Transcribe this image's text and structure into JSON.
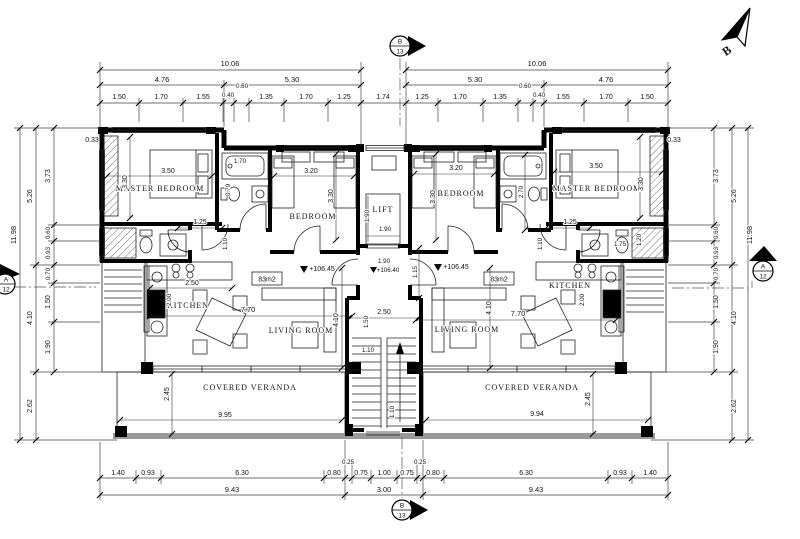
{
  "compass": {
    "north_letter": "B"
  },
  "markers": {
    "top": {
      "letter": "B",
      "number": "13"
    },
    "bottom": {
      "letter": "B",
      "number": "13"
    },
    "left": {
      "letter": "A",
      "number": "12"
    },
    "right": {
      "letter": "A",
      "number": "12"
    }
  },
  "core": {
    "lift_label": "LIFT",
    "lift_w": "1.90",
    "lift_d": "1.90",
    "landing_w": "1.90",
    "landing_level": "+106.40",
    "landing_d": "1.15",
    "stair_w": "2.50",
    "stair_d1": "1.50",
    "stair_d2": "1.10",
    "stair_d3": "1.10"
  },
  "apartments": {
    "left": {
      "master_label": "MASTER BEDROOM",
      "master_w": "3.50",
      "master_d": "3.30",
      "master_door": "1.25",
      "bedroom_label": "BEDROOM",
      "bedroom_w": "3.20",
      "bedroom_d": "3.30",
      "tub": "1.70",
      "wc": "0.70",
      "hall": "1.10",
      "kitchen_label": "KITCHEN",
      "kitchen_w": "2.50",
      "kitchen_d": "2.00",
      "living_label": "LIVING ROOM",
      "living_w": "7.70",
      "living_d": "4.10",
      "area": "83m2",
      "level": "+106.45",
      "veranda_label": "COVERED VERANDA",
      "veranda_w": "9.95",
      "veranda_d": "2.45",
      "corner": "0.33"
    },
    "right": {
      "master_label": "MASTER BEDROOM",
      "master_w": "3.50",
      "master_d": "3.30",
      "master_door": "1.25",
      "bedroom_label": "BEDROOM",
      "bedroom_w": "3.20",
      "bedroom_d": "3.30",
      "bath_d": "2.70",
      "hall": "1.10",
      "ensuite_w": "1.75",
      "ensuite_d": "1.20",
      "kitchen_label": "KITCHEN",
      "kitchen_d": "2.00",
      "living_label": "LIVING ROOM",
      "living_w": "7.70",
      "living_d": "4.10",
      "area": "83m2",
      "level": "+106.45",
      "veranda_label": "COVERED VERANDA",
      "veranda_w": "9.94",
      "veranda_d": "2.45",
      "corner": "0.33"
    }
  },
  "dims": {
    "top": {
      "total_left": "10.06",
      "total_right": "10.06",
      "sub": [
        "4.76",
        "5.30",
        "5.30",
        "4.76"
      ],
      "center": "1.74",
      "left": [
        "1.50",
        "1.70",
        "1.55",
        "0.40",
        "0.60",
        "1.35",
        "1.70",
        "1.25"
      ],
      "right": [
        "1.25",
        "1.70",
        "1.35",
        "0.60",
        "0.40",
        "1.55",
        "1.70",
        "1.50"
      ]
    },
    "side": {
      "total": "11.98",
      "mid": [
        "5.26",
        "4.10",
        "2.62"
      ],
      "detail": [
        "3.73",
        "0.60",
        "0.93",
        "0.70",
        "1.50",
        "1.90"
      ]
    },
    "bottom": {
      "row": [
        "1.40",
        "0.93",
        "6.30",
        "0.80",
        "0.25",
        "0.75",
        "1.00",
        "0.75",
        "0.25",
        "0.80",
        "6.30",
        "0.93",
        "1.40"
      ],
      "totals": [
        "9.43",
        "3.00",
        "9.43"
      ]
    }
  }
}
